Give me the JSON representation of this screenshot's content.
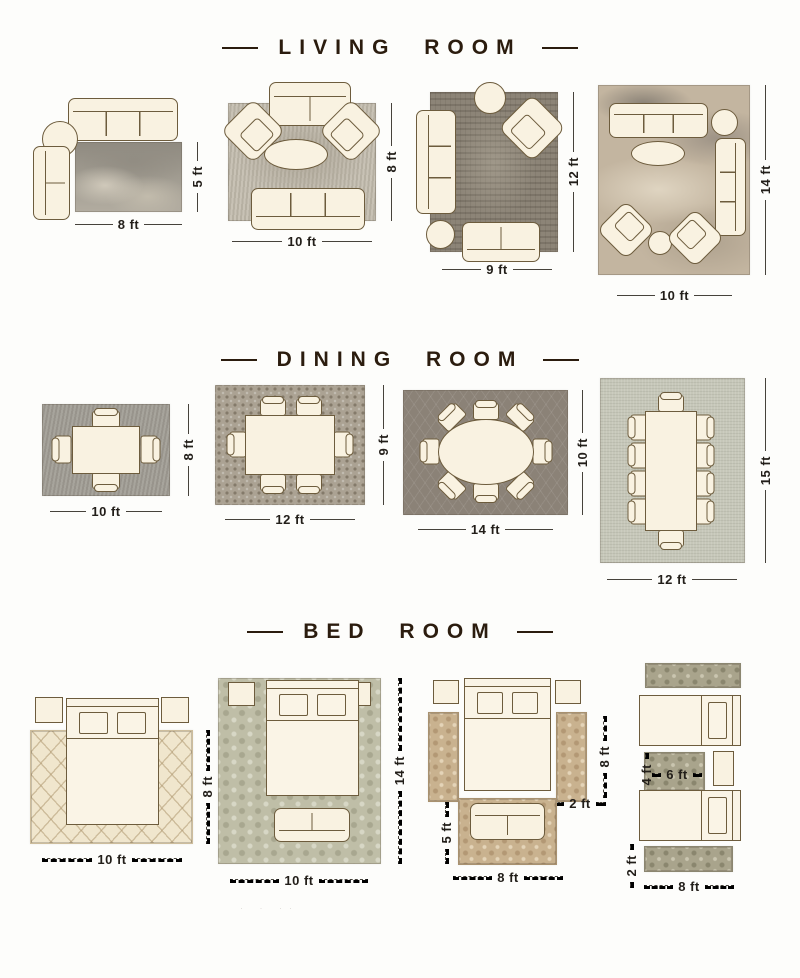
{
  "colors": {
    "ink": "#2b1c0e",
    "furniture_outline": "#6d5c3d",
    "furniture_fill": "#f9f2e1",
    "dimension_text": "#221e19"
  },
  "sections": [
    {
      "title": "LIVING ROOM",
      "layouts": [
        {
          "labels": {
            "w": "8 ft",
            "h": "5 ft"
          }
        },
        {
          "labels": {
            "w": "10 ft",
            "h": "8 ft"
          }
        },
        {
          "labels": {
            "w": "9 ft",
            "h": "12 ft"
          }
        },
        {
          "labels": {
            "w": "10 ft",
            "h": "14 ft"
          }
        }
      ]
    },
    {
      "title": "DINING ROOM",
      "layouts": [
        {
          "labels": {
            "w": "10 ft",
            "h": "8 ft"
          }
        },
        {
          "labels": {
            "w": "12 ft",
            "h": "9 ft"
          }
        },
        {
          "labels": {
            "w": "14 ft",
            "h": "10 ft"
          }
        },
        {
          "labels": {
            "w": "12 ft",
            "h": "15 ft"
          }
        }
      ]
    },
    {
      "title": "BED ROOM",
      "layouts": [
        {
          "labels": {
            "w": "10 ft",
            "h": "8 ft"
          }
        },
        {
          "labels": {
            "w": "10 ft",
            "h": "14 ft"
          }
        },
        {
          "labels": {
            "runner_len": "8 ft",
            "runner_w": "2 ft",
            "foot_h": "5 ft",
            "foot_w": "8 ft"
          }
        },
        {
          "labels": {
            "mid_h": "4 ft",
            "mid_w": "6 ft",
            "runner_w": "2 ft",
            "w": "8 ft"
          }
        }
      ]
    }
  ],
  "faint_marks": "· · ··"
}
